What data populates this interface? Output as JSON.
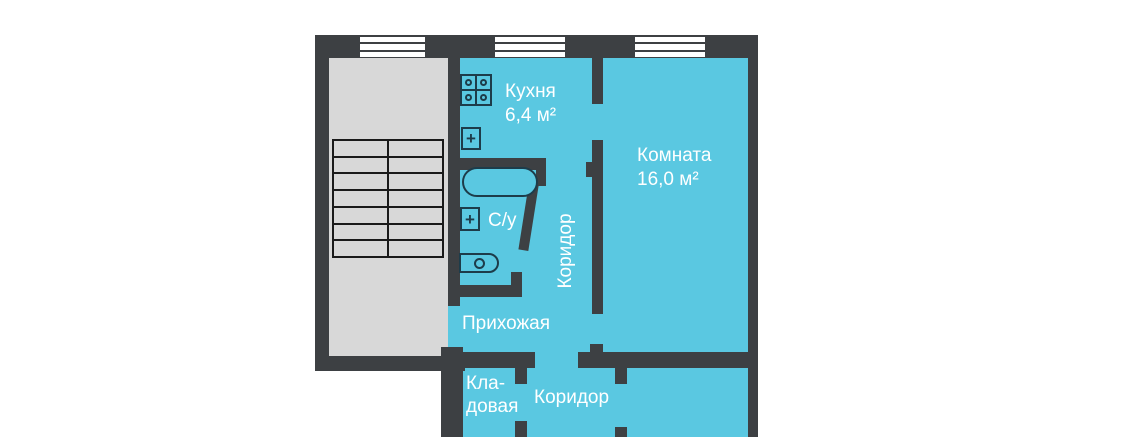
{
  "document_type": "apartment floor plan",
  "colors": {
    "background": "#ffffff",
    "wall": "#3d4043",
    "floor": "#5ac8e1",
    "stairwell": "#d8d8d8",
    "fixture": "#1d3c4a",
    "stairs_line": "#1a1a1a",
    "label_text": "#ffffff"
  },
  "rooms": {
    "kitchen": {
      "name": "Кухня",
      "area": "6,4 м²"
    },
    "living_room": {
      "name": "Комната",
      "area": "16,0 м²"
    },
    "bathroom": {
      "name": "С/у"
    },
    "corridor": {
      "name": "Коридор"
    },
    "hallway": {
      "name": "Прихожая"
    },
    "storage": {
      "name_line_1": "Кла-",
      "name_line_2": "довая"
    },
    "corridor_lower": {
      "name": "Коридор"
    }
  },
  "fixtures": [
    "stove-icon",
    "kitchen-sink-icon",
    "bathtub-icon",
    "bathroom-sink-icon",
    "toilet-icon",
    "stairs-icon",
    "window-icon"
  ],
  "windows_count": 3
}
